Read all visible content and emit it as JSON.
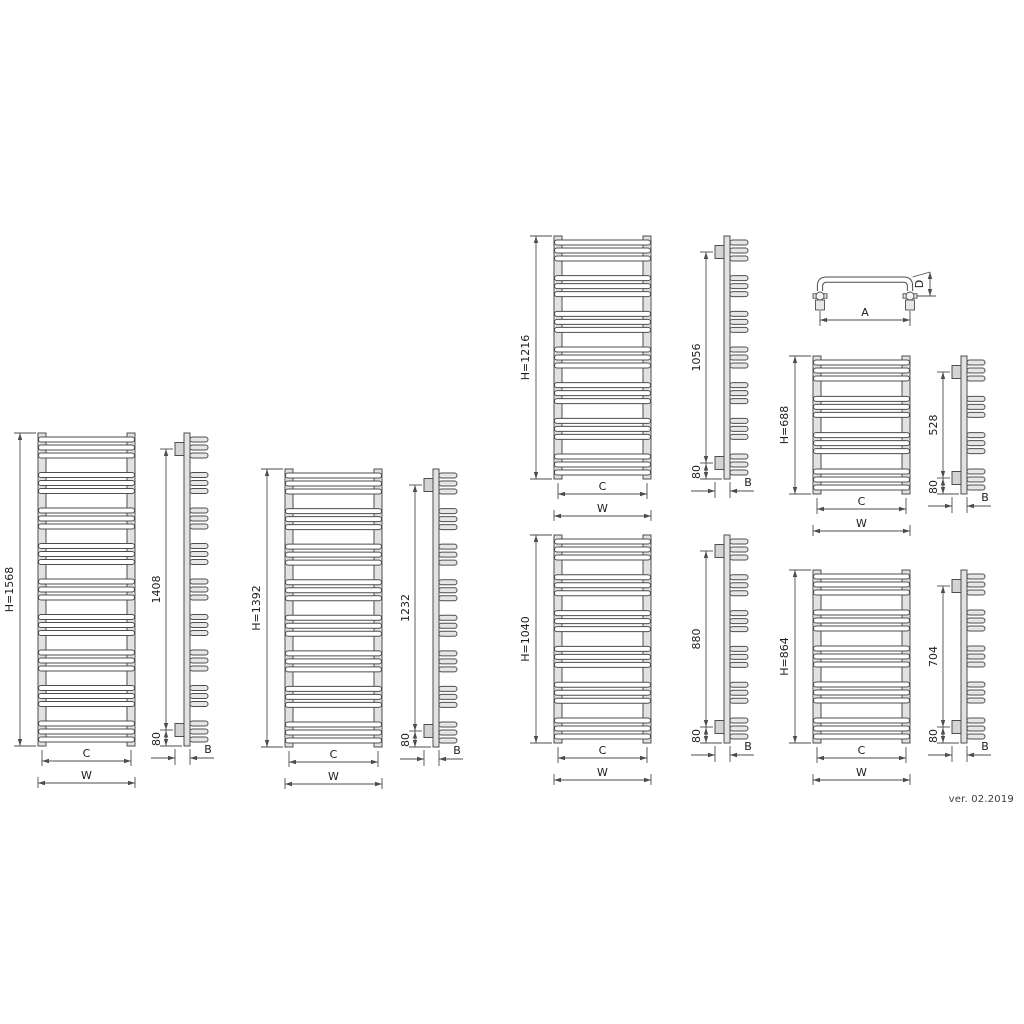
{
  "version_label": "ver. 02.2019",
  "shared_labels": {
    "inner_width": "C",
    "overall_width": "W",
    "wall_depth": "B"
  },
  "detail_view": {
    "name": "towel-bar-top-view",
    "width_label": "A",
    "depth_label": "D"
  },
  "radiators": [
    {
      "height_label": "H=1568",
      "connection_span_label": "1408",
      "bottom_offset_label": "80",
      "bar_groups": 9,
      "bars_per_group": 3,
      "bars_total": 27
    },
    {
      "height_label": "H=1392",
      "connection_span_label": "1232",
      "bottom_offset_label": "80",
      "bar_groups": 8,
      "bars_per_group": 3,
      "bars_total": 24
    },
    {
      "height_label": "H=1216",
      "connection_span_label": "1056",
      "bottom_offset_label": "80",
      "bar_groups": 7,
      "bars_per_group": 3,
      "bars_total": 21
    },
    {
      "height_label": "H=1040",
      "connection_span_label": "880",
      "bottom_offset_label": "80",
      "bar_groups": 6,
      "bars_per_group": 3,
      "bars_total": 18
    },
    {
      "height_label": "H=688",
      "connection_span_label": "528",
      "bottom_offset_label": "80",
      "bar_groups": 4,
      "bars_per_group": 3,
      "bars_total": 12
    },
    {
      "height_label": "H=864",
      "connection_span_label": "704",
      "bottom_offset_label": "80",
      "bar_groups": 5,
      "bars_per_group": 3,
      "bars_total": 15
    }
  ],
  "colors": {
    "line": "#4d4d4d",
    "text": "#1c1c1c",
    "rail_fill": "#e2e2e2",
    "bar_fill": "#ffffff",
    "capsule_fill": "#e6e6e6",
    "bracket_fill": "#d4d4d4",
    "background": "#ffffff"
  }
}
